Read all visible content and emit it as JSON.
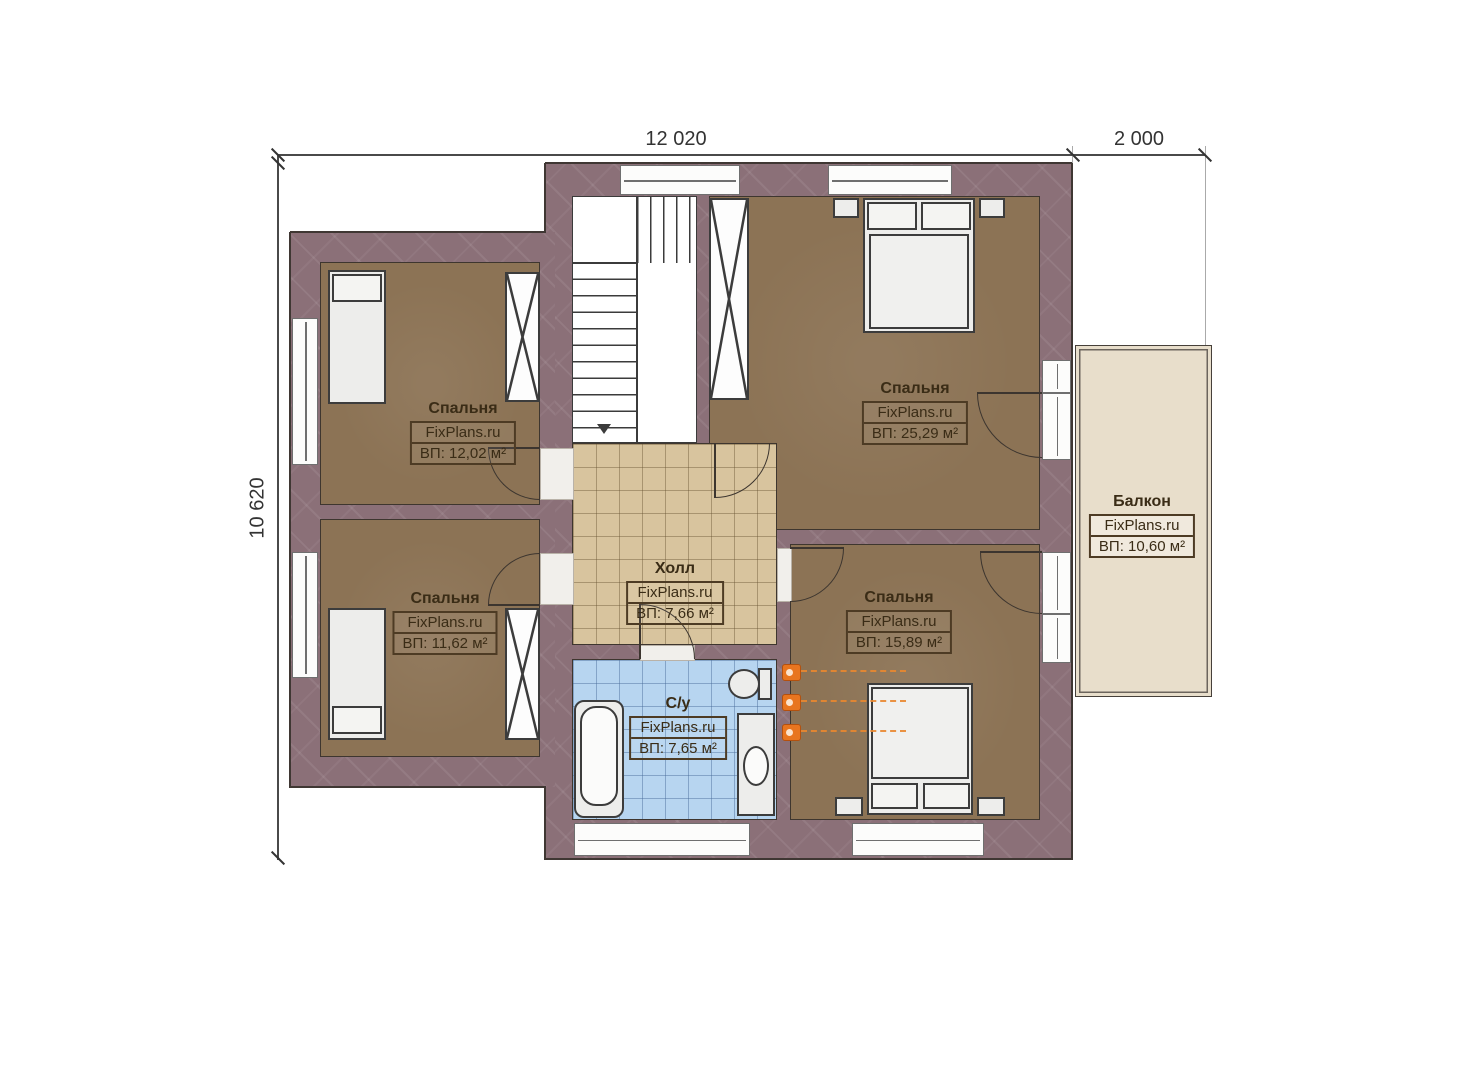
{
  "dimensions": {
    "top_width": "12 020",
    "balcony_width": "2 000",
    "left_height": "10 620"
  },
  "rooms": [
    {
      "key": "bedroom-top-left",
      "name": "Спальня",
      "brand": "FixPlans.ru",
      "area": "ВП: 12,02 м²"
    },
    {
      "key": "bedroom-top-right",
      "name": "Спальня",
      "brand": "FixPlans.ru",
      "area": "ВП: 25,29 м²"
    },
    {
      "key": "bedroom-bottom-left",
      "name": "Спальня",
      "brand": "FixPlans.ru",
      "area": "ВП: 11,62 м²"
    },
    {
      "key": "hall",
      "name": "Холл",
      "brand": "FixPlans.ru",
      "area": "ВП: 7,66 м²"
    },
    {
      "key": "bathroom",
      "name": "С/у",
      "brand": "FixPlans.ru",
      "area": "ВП: 7,65 м²"
    },
    {
      "key": "bedroom-bottom-right",
      "name": "Спальня",
      "brand": "FixPlans.ru",
      "area": "ВП: 15,89 м²"
    },
    {
      "key": "balcony",
      "name": "Балкон",
      "brand": "FixPlans.ru",
      "area": "ВП: 10,60 м²"
    }
  ]
}
